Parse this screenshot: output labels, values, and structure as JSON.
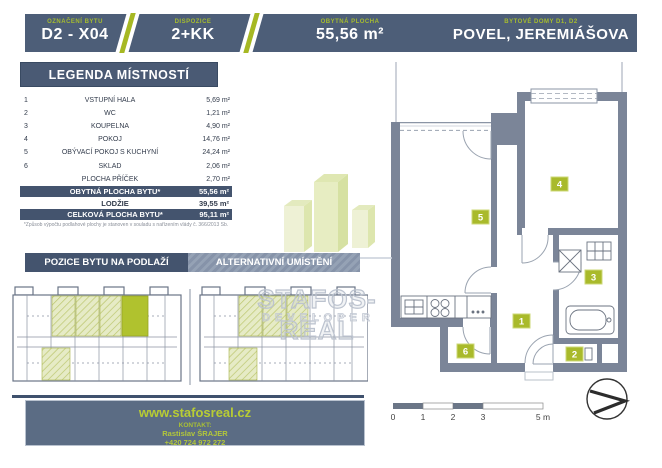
{
  "header": {
    "cells": [
      {
        "label": "OZNAČENÍ BYTU",
        "value": "D2 - X04"
      },
      {
        "label": "DISPOZICE",
        "value": "2+KK"
      },
      {
        "label": "OBYTNÁ PLOCHA",
        "value": "55,56 m²"
      },
      {
        "label": "BYTOVÉ DOMY D1, D2",
        "value": "POVEL, JEREMIÁŠOVA"
      }
    ]
  },
  "legend": {
    "title": "LEGENDA MÍSTNOSTÍ",
    "rooms": [
      {
        "num": "1",
        "name": "VSTUPNÍ HALA",
        "area": "5,69 m²"
      },
      {
        "num": "2",
        "name": "WC",
        "area": "1,21 m²"
      },
      {
        "num": "3",
        "name": "KOUPELNA",
        "area": "4,90 m²"
      },
      {
        "num": "4",
        "name": "POKOJ",
        "area": "14,76 m²"
      },
      {
        "num": "5",
        "name": "OBÝVACÍ POKOJ S KUCHYNÍ",
        "area": "24,24 m²"
      },
      {
        "num": "6",
        "name": "SKLAD",
        "area": "2,06 m²"
      },
      {
        "num": "",
        "name": "PLOCHA PŘÍČEK",
        "area": "2,70 m²"
      }
    ],
    "summary": [
      {
        "name": "OBYTNÁ PLOCHA BYTU*",
        "area": "55,56 m²"
      },
      {
        "name": "LODŽIE",
        "area": "39,55 m²"
      },
      {
        "name": "CELKOVÁ PLOCHA BYTU*",
        "area": "95,11 m²"
      }
    ],
    "footnote": "*Způsob výpočtu podlahové plochy je stanoven v souladu s nařízením vlády č. 366/2013 Sb."
  },
  "position": {
    "tab_primary": "POZICE BYTU NA PODLAŽÍ",
    "tab_secondary": "ALTERNATIVNÍ UMÍSTĚNÍ"
  },
  "plan": {
    "badges": [
      "1",
      "2",
      "3",
      "4",
      "5",
      "6"
    ],
    "scale_ticks": [
      "0",
      "1",
      "2",
      "3",
      "5 m"
    ]
  },
  "watermark": {
    "brand": "STAFOS-REAL",
    "subtitle": "DEVELOPER"
  },
  "footer": {
    "website": "www.stafosreal.cz",
    "contact_label": "KONTAKT:",
    "contact_name": "Rastislav ŠRAJER",
    "contact_phone": "+420 724 972 272"
  },
  "colors": {
    "header_slate": "#4d5e78",
    "navy_bar": "#44546e",
    "accent_green": "#a6b823",
    "badge_green": "#a9ba2b",
    "wall_gray": "#7b8598",
    "footer_bg": "#5b6c84"
  }
}
